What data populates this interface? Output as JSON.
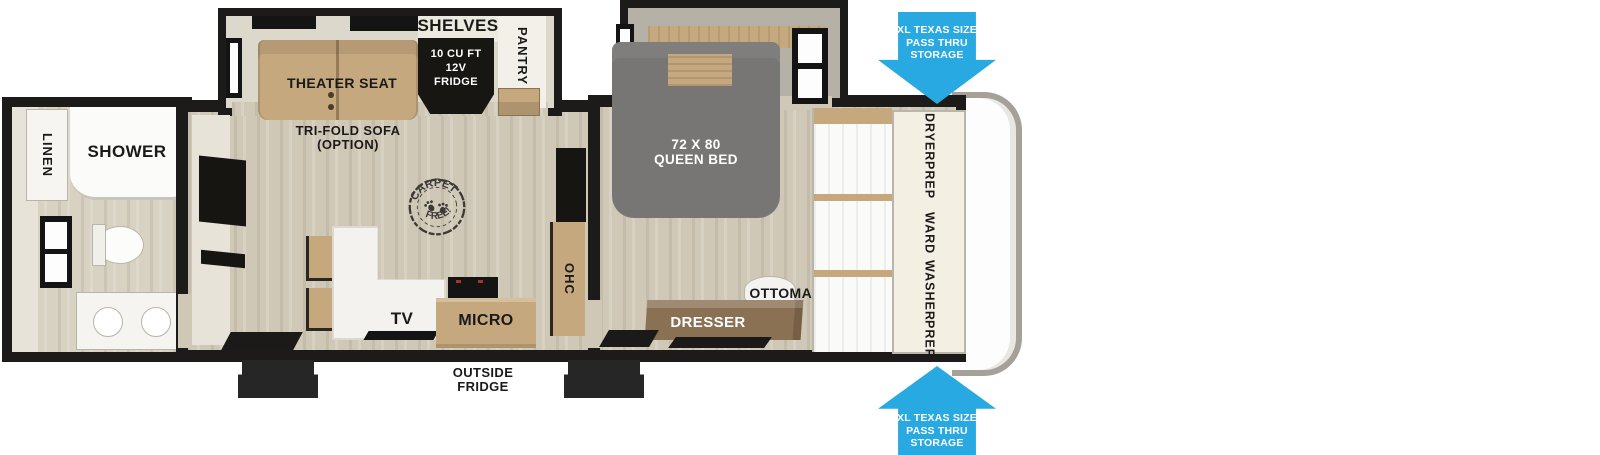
{
  "colors": {
    "arrow_blue": "#29a9e1",
    "wall_black": "#1d1b19",
    "floor_wood": "#cfc8b7",
    "floor_wood_light": "#d8d2c3",
    "cabinet_tan": "#c5a87e",
    "counter_white": "#f3f2ee",
    "bed_gray": "#777675",
    "dresser_brown": "#8a7153",
    "panel_cream": "#f3f0e3",
    "cap_gray": "#a5a199"
  },
  "exterior": {
    "pass_thru_top": {
      "line1": "XL TEXAS SIZE",
      "line2": "PASS THRU",
      "line3": "STORAGE"
    },
    "pass_thru_bottom": {
      "line1": "XL TEXAS SIZE",
      "line2": "PASS THRU",
      "line3": "STORAGE"
    },
    "outside_fridge": {
      "line1": "OUTSIDE",
      "line2": "FRIDGE"
    }
  },
  "bathroom": {
    "linen": "LINEN",
    "shower": "SHOWER"
  },
  "living": {
    "shelves": "SHELVES",
    "pantry": "PANTRY",
    "theater_seat": "THEATER SEAT",
    "fridge": {
      "line1": "10 CU FT",
      "line2": "12V",
      "line3": "FRIDGE"
    },
    "trifold": {
      "line1": "TRI-FOLD SOFA",
      "line2": "(OPTION)"
    },
    "stamp": {
      "top": "CARPET",
      "bottom": "FREE!"
    },
    "ohc": "OHC",
    "tv": "TV",
    "micro": "MICRO"
  },
  "bedroom": {
    "bed": {
      "line1": "72 X 80",
      "line2": "QUEEN BED"
    },
    "ottoman": "OTTOMAN",
    "dresser": "DRESSER",
    "dryer_prep": {
      "line1": "DRYER",
      "line2": "PREP"
    },
    "ward": "WARD",
    "washer_prep": {
      "line1": "WASHER",
      "line2": "PREP"
    }
  }
}
